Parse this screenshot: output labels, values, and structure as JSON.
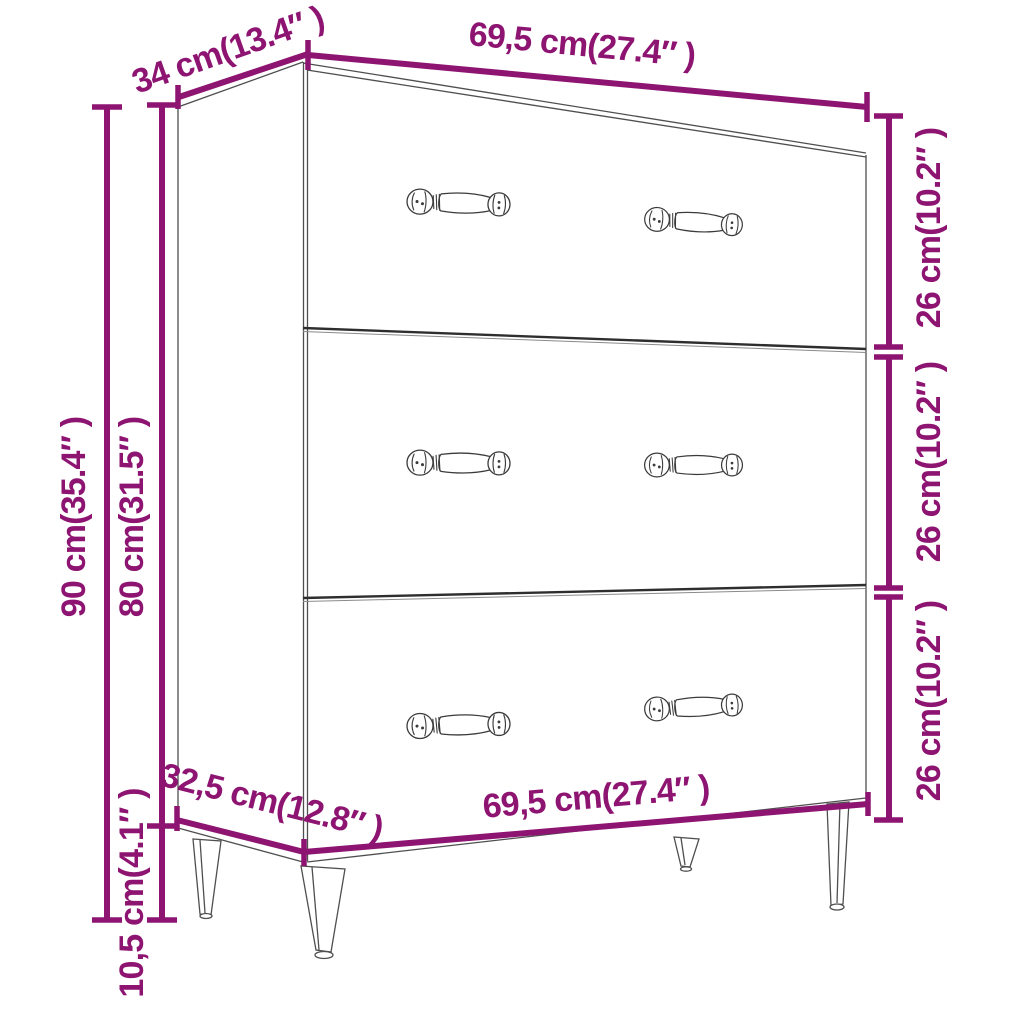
{
  "diagram": {
    "title": "Sideboard dimension diagram",
    "product": "3-drawer sideboard with tapered metal legs",
    "accent_color": "#8E1472",
    "line_color": "#4F4F4F",
    "background_color": "#FFFFFF"
  },
  "dimensions": {
    "top_depth": "34 cm(13.4″ )",
    "top_width": "69,5 cm(27.4″ )",
    "total_height": "90 cm(35.4″ )",
    "body_height": "80 cm(31.5″ )",
    "leg_height": "10,5 cm(4.1″ )",
    "bottom_depth": "32,5 cm(12.8″ )",
    "bottom_width": "69,5 cm(27.4″ )",
    "drawer_heights": [
      "26 cm(10.2″ )",
      "26 cm(10.2″ )",
      "26 cm(10.2″ )"
    ]
  }
}
